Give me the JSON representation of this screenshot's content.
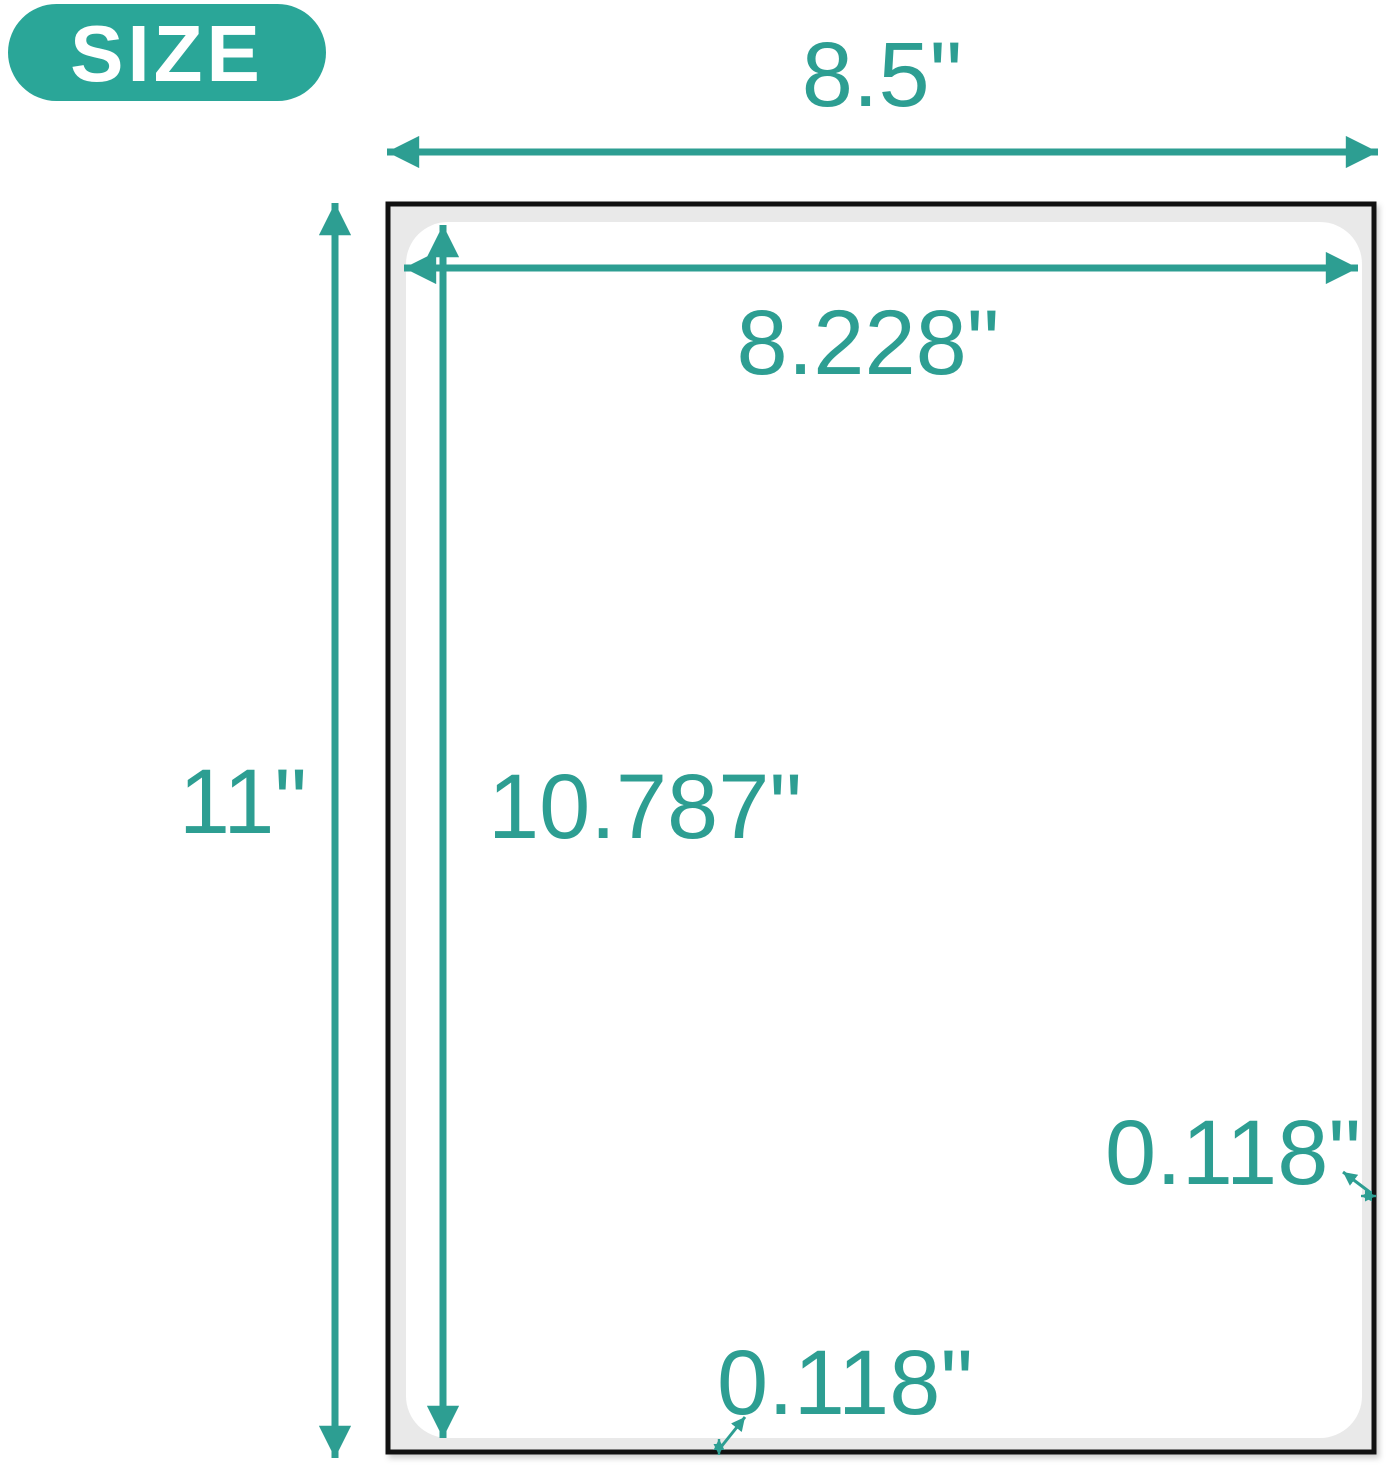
{
  "badge": {
    "label": "SIZE"
  },
  "colors": {
    "accent": "#2d9e92",
    "badge_bg": "#2aa698",
    "badge_text": "#ffffff",
    "page_border": "#111111",
    "page_margin_fill": "#e9e9e9",
    "label_fill": "#ffffff",
    "background": "#ffffff"
  },
  "labels": {
    "sheet_width": "8.5\"",
    "sheet_height": "11\"",
    "label_width": "8.228\"",
    "label_height": "10.787\"",
    "bottom_margin": "0.118\"",
    "right_margin": "0.118\""
  }
}
